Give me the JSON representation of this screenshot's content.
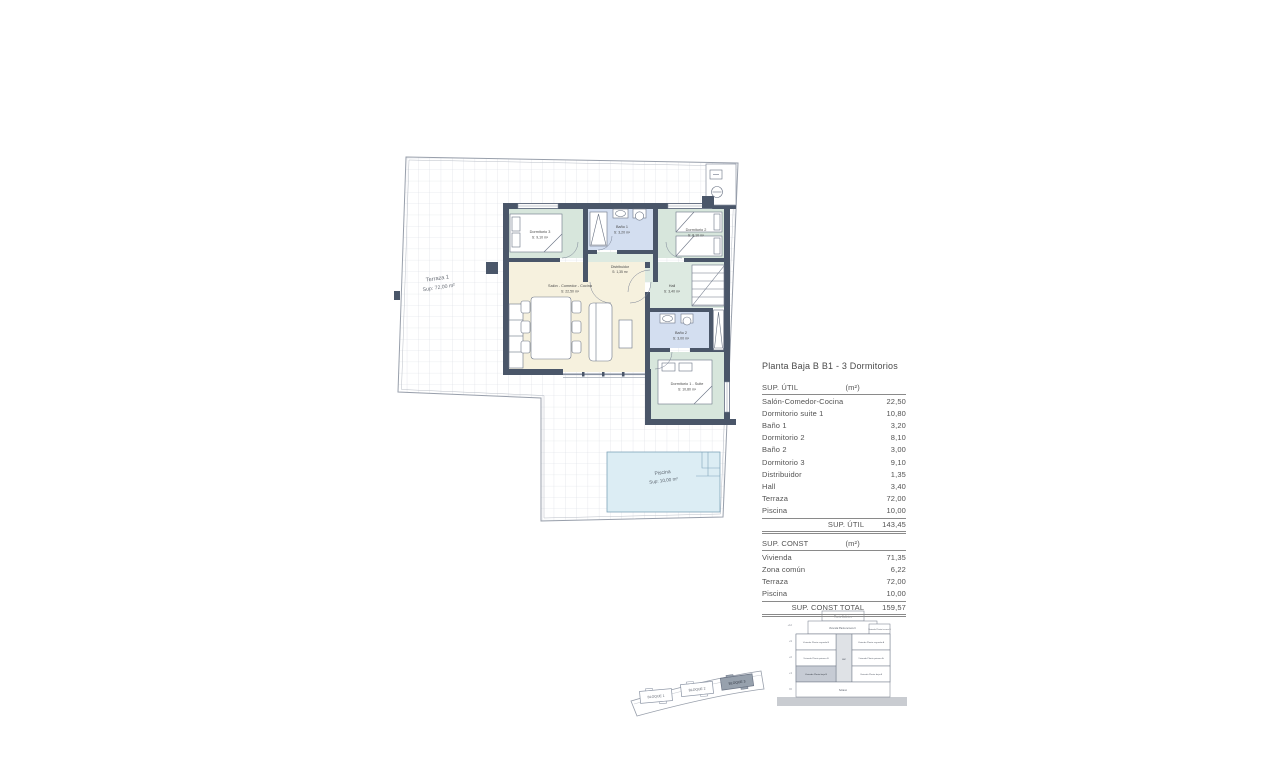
{
  "page": {
    "title": "Planta Baja B B1 - 3 Dormitorios"
  },
  "plan": {
    "terraza_name": "Terraza 1",
    "terraza_area": "Sup: 72,00 m²",
    "piscina_name": "Piscina",
    "piscina_area": "Sup: 10,00 m²",
    "rooms": {
      "dormitorio3": {
        "name": "Dormitorio 3",
        "area": "S: 9,10 m²"
      },
      "bano1": {
        "name": "Baño 1",
        "area": "S: 3,20 m²"
      },
      "dormitorio2": {
        "name": "Dormitorio 2",
        "area": "S: 8,10 m²"
      },
      "distribuidor": {
        "name": "Distribuidor",
        "area": "S: 1,35 m²"
      },
      "salon": {
        "name": "Salón - Comedor - Cocina",
        "area": "S: 22,50 m²"
      },
      "hall": {
        "name": "Hall",
        "area": "S: 3,40 m²"
      },
      "bano2": {
        "name": "Baño 2",
        "area": "S: 3,00 m²"
      },
      "suite": {
        "name": "Dormitorio 1 - Suite",
        "area": "S: 10,80 m²"
      }
    }
  },
  "tables": {
    "util": {
      "header_label": "SUP. ÚTIL",
      "header_unit": "(m²)",
      "rows": [
        {
          "label": "Salón-Comedor-Cocina",
          "value": "22,50"
        },
        {
          "label": "Dormitorio suite 1",
          "value": "10,80"
        },
        {
          "label": "Baño 1",
          "value": "3,20"
        },
        {
          "label": "Dormitorio 2",
          "value": "8,10"
        },
        {
          "label": "Baño 2",
          "value": "3,00"
        },
        {
          "label": "Dormitorio 3",
          "value": "9,10"
        },
        {
          "label": "Distribuidor",
          "value": "1,35"
        },
        {
          "label": "Hall",
          "value": "3,40"
        },
        {
          "label": "Terraza",
          "value": "72,00"
        },
        {
          "label": "Piscina",
          "value": "10,00"
        }
      ],
      "total_label": "SUP. ÚTIL",
      "total_value": "143,45"
    },
    "const": {
      "header_label": "SUP. CONST",
      "header_unit": "(m²)",
      "rows": [
        {
          "label": "Vivienda",
          "value": "71,35"
        },
        {
          "label": "Zona común",
          "value": "6,22"
        },
        {
          "label": "Terraza",
          "value": "72,00"
        },
        {
          "label": "Piscina",
          "value": "10,00"
        }
      ],
      "total_label": "SUP. CONST TOTAL",
      "total_value": "159,57"
    }
  },
  "section": {
    "solarium": "Planta Solárium",
    "tercera_wide": "Vivienda Planta tercera C",
    "tercera_right": "Vivienda Planta tercera B",
    "shaft": "asc",
    "levels_left": [
      "Vivienda Planta segunda B",
      "Vivienda Planta primera B",
      "Vivienda Planta baja B"
    ],
    "levels_right": [
      "Vivienda Planta segunda A",
      "Vivienda Planta primera A",
      "Vivienda Planta baja A"
    ],
    "sotano": "Sótano",
    "elevations": [
      "+12",
      "+9",
      "+6",
      "+3",
      "±0"
    ]
  },
  "site": {
    "blocks": [
      "BLOQUE 1",
      "BLOQUE 2",
      "BLOQUE 3"
    ]
  },
  "colors": {
    "wall": "#4a5669",
    "bedroom": "#d7e6dc",
    "bath": "#d3def0",
    "salon": "#f6f1de",
    "pool": "#dcedf4",
    "highlight": "#c6cbd4"
  }
}
